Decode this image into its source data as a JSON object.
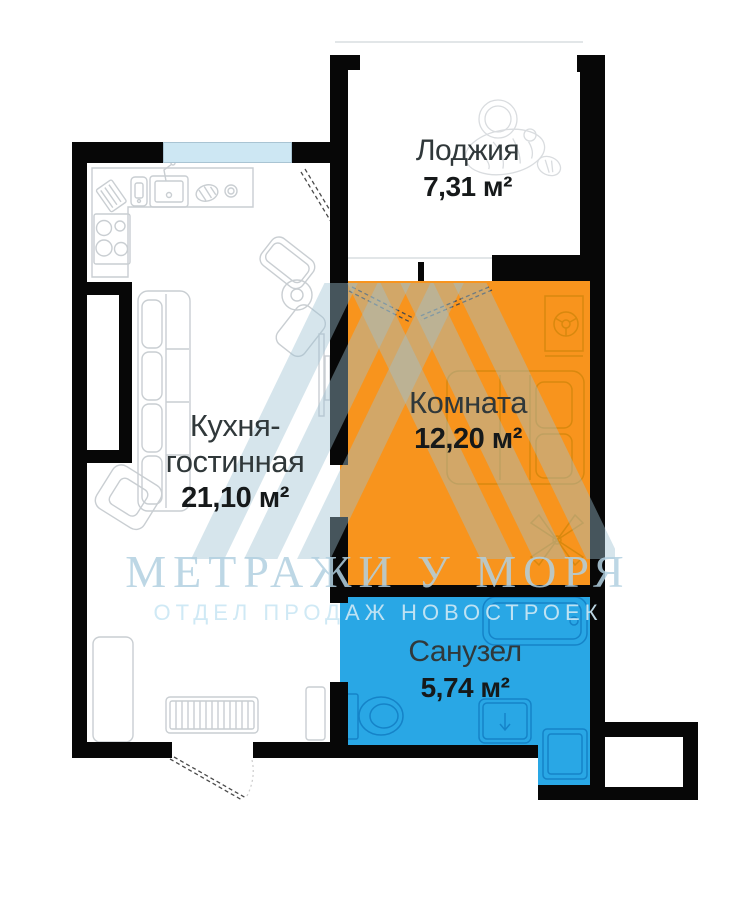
{
  "plan": {
    "rooms": [
      {
        "name": "Лоджия",
        "area": "7,31 м²"
      },
      {
        "name_lines": [
          "Кухня-",
          "гостинная"
        ],
        "area": "21,10 м²"
      },
      {
        "name": "Комната",
        "area": "12,20 м²"
      },
      {
        "name": "Санузел",
        "area": "5,74 м²"
      }
    ],
    "watermark": {
      "title": "МЕТРАЖИ У МОРЯ",
      "subtitle": "ОТДЕЛ ПРОДАЖ НОВОСТРОЕК"
    },
    "colors": {
      "room_orange": "#F8941D",
      "bath_blue": "#29A7E5",
      "window_blue": "#CDE7F3",
      "wall_black": "#070707",
      "watermark_blue": "#CFE6F2"
    }
  }
}
